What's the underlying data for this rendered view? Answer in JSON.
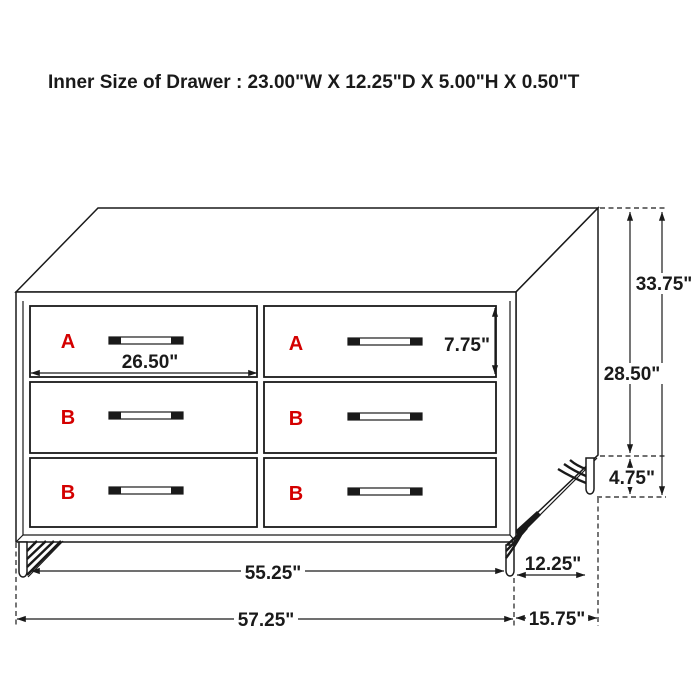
{
  "title": "Inner Size of Drawer : 23.00\"W X 12.25\"D X 5.00\"H X 0.50\"T",
  "colors": {
    "line": "#1a1a1a",
    "drawer_label": "#d40000",
    "background": "#ffffff"
  },
  "drawers": [
    {
      "label": "A",
      "column": "left",
      "row": 1
    },
    {
      "label": "A",
      "column": "right",
      "row": 1
    },
    {
      "label": "B",
      "column": "left",
      "row": 2
    },
    {
      "label": "B",
      "column": "right",
      "row": 2
    },
    {
      "label": "B",
      "column": "left",
      "row": 3
    },
    {
      "label": "B",
      "column": "right",
      "row": 3
    }
  ],
  "dimensions": {
    "drawer_front_width": "26.50\"",
    "drawer_front_height": "7.75\"",
    "total_height": "33.75\"",
    "body_height": "28.50\"",
    "leg_height": "4.75\"",
    "leg_span_width": "55.25\"",
    "total_width": "57.25\"",
    "leg_span_depth": "12.25\"",
    "total_depth": "15.75\""
  }
}
